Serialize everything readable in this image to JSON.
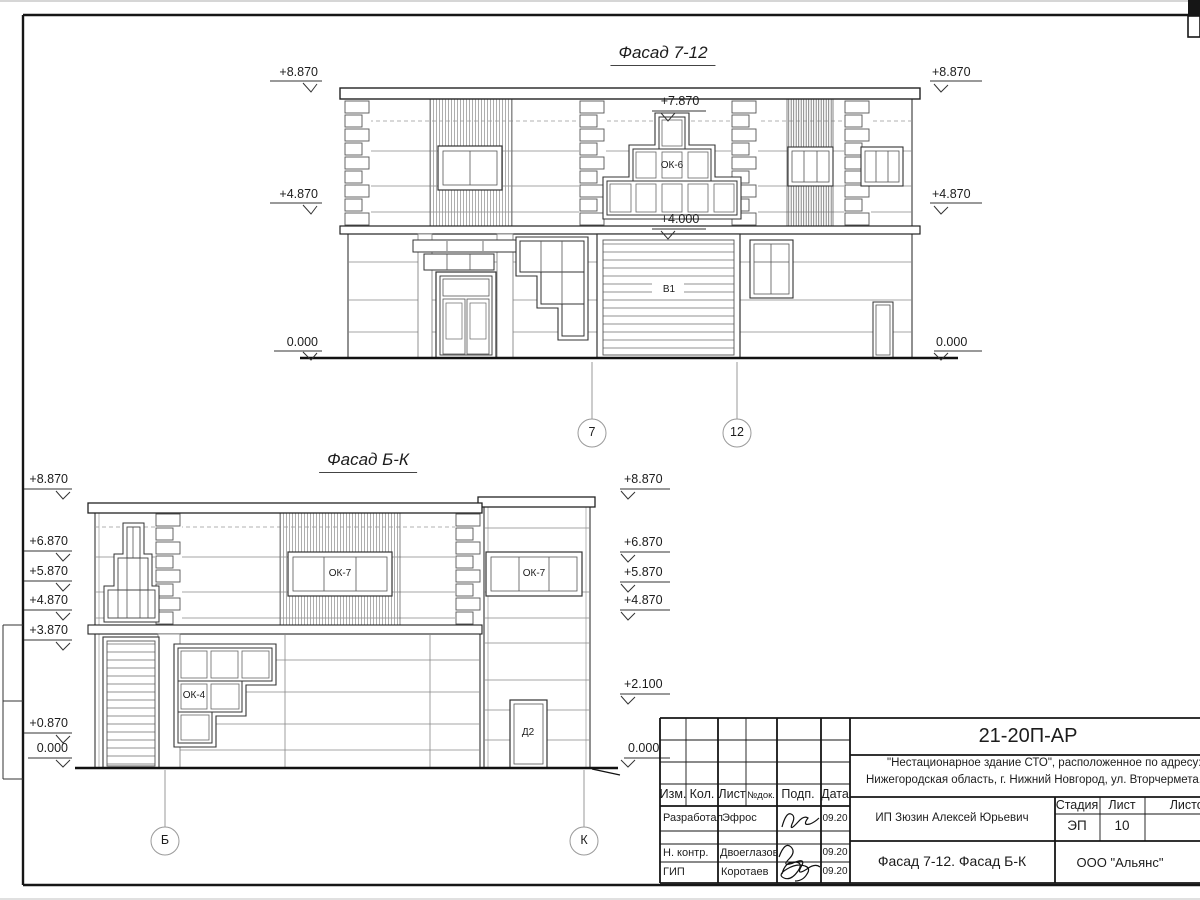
{
  "drawing": {
    "top_facade": {
      "title": "Фасад 7-12",
      "marks_left": [
        "+8.870",
        "+4.870",
        "0.000"
      ],
      "marks_right": [
        "+8.870",
        "+4.870",
        "0.000"
      ],
      "mark_window_top": "+7.870",
      "mark_gate_top": "+4.000",
      "label_window": "ОК-6",
      "label_gate": "В1",
      "axis_left": "7",
      "axis_right": "12"
    },
    "bottom_facade": {
      "title": "Фасад Б-К",
      "marks_left": [
        "+8.870",
        "+6.870",
        "+5.870",
        "+4.870",
        "+3.870",
        "+0.870",
        "0.000"
      ],
      "marks_right": [
        "+8.870",
        "+6.870",
        "+5.870",
        "+4.870",
        "+2.100",
        "0.000"
      ],
      "label_window_left": "ОК-7",
      "label_window_right": "ОК-7",
      "label_window_stepped": "ОК-4",
      "label_door": "Д2",
      "axis_left": "Б",
      "axis_right": "К"
    }
  },
  "title_block": {
    "doc_number": "21-20П-АР",
    "description_line1": "\"Нестационарное здание СТО\", расположенное по адресу:",
    "description_line2": "Нижегородская область, г. Нижний Новгород, ул. Вторчермета, 1А",
    "columns": [
      "Изм.",
      "Кол.",
      "Лист",
      "№док.",
      "Подп.",
      "Дата"
    ],
    "rows": [
      {
        "role": "Разработал",
        "name": "Эфрос",
        "date": "09.20"
      },
      {
        "role": "Н. контр.",
        "name": "Двоеглазов",
        "date": "09.20"
      },
      {
        "role": "ГИП",
        "name": "Коротаев",
        "date": "09.20"
      }
    ],
    "client": "ИП Зюзин Алексей Юрьевич",
    "stage_label": "Стадия",
    "sheet_label": "Лист",
    "sheets_label": "Листов",
    "stage_value": "ЭП",
    "sheet_value": "10",
    "sheet_title": "Фасад 7-12. Фасад Б-К",
    "organization": "ООО \"Альянс\""
  }
}
